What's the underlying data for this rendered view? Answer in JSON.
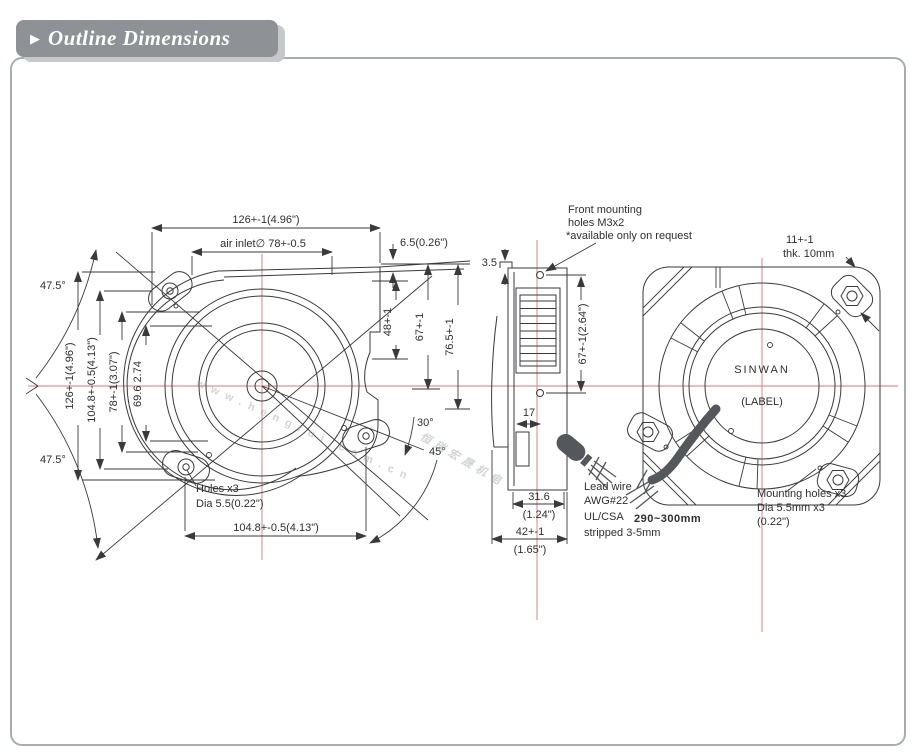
{
  "header": {
    "title": "Outline Dimensions",
    "arrow_icon": "▶"
  },
  "colors": {
    "line": "#3a3a3c",
    "centerline_red": "#d87878",
    "header_gray": "#8e9296",
    "border_gray": "#a9adb0",
    "wire_dark": "#54575c",
    "watermark_gray": "#8f9397"
  },
  "watermark": {
    "cn_text": "恒瑞宏晟机电",
    "url_text": "www.hengrui.com.cn"
  },
  "front_view": {
    "width_top": "126+-1(4.96\")",
    "air_inlet": "air inlet∅ 78+-0.5",
    "outlet_lip": "6.5(0.26\")",
    "dim_48": "48+-1",
    "dim_67": "67+-1",
    "dim_76": "76.5+-1",
    "height_left": "126+-1(4.96\")",
    "holes_height": "104.8+-0.5(4.13\")",
    "inlet_height": "78+-1(3.07\")",
    "dim_69": "69.6  2.74",
    "angle_top": "47.5°",
    "angle_bottom": "47.5°",
    "angle_30": "30°",
    "angle_45": "45°",
    "holes_note_1": "Holes x3",
    "holes_note_2": "Dia 5.5(0.22\")",
    "width_bottom": "104.8+-0.5(4.13\")"
  },
  "side_view": {
    "dim_3_5": "3.5",
    "hole_pitch": "67+-1(2.64\")",
    "dim_17": "17",
    "outlet_mm": "31.6",
    "outlet_in": "(1.24\")",
    "depth_mm": "42+-1",
    "depth_in": "(1.65\")",
    "front_holes_1": "Front mounting",
    "front_holes_2": "holes M3x2",
    "front_holes_3": "*available only on request"
  },
  "rear_view": {
    "flange_1": "11+-1",
    "flange_2": "thk. 10mm",
    "label_1": "SINWAN",
    "label_2": "(LABEL)",
    "mount_1": "Mounting holes x3",
    "mount_2": "Dia 5.5mm x3",
    "mount_3": "(0.22\")"
  },
  "lead_wire": {
    "l1": "Lead wire",
    "l2": "AWG#22",
    "l3": "UL/CSA",
    "l4": "290~300mm",
    "l5": "stripped 3-5mm"
  }
}
